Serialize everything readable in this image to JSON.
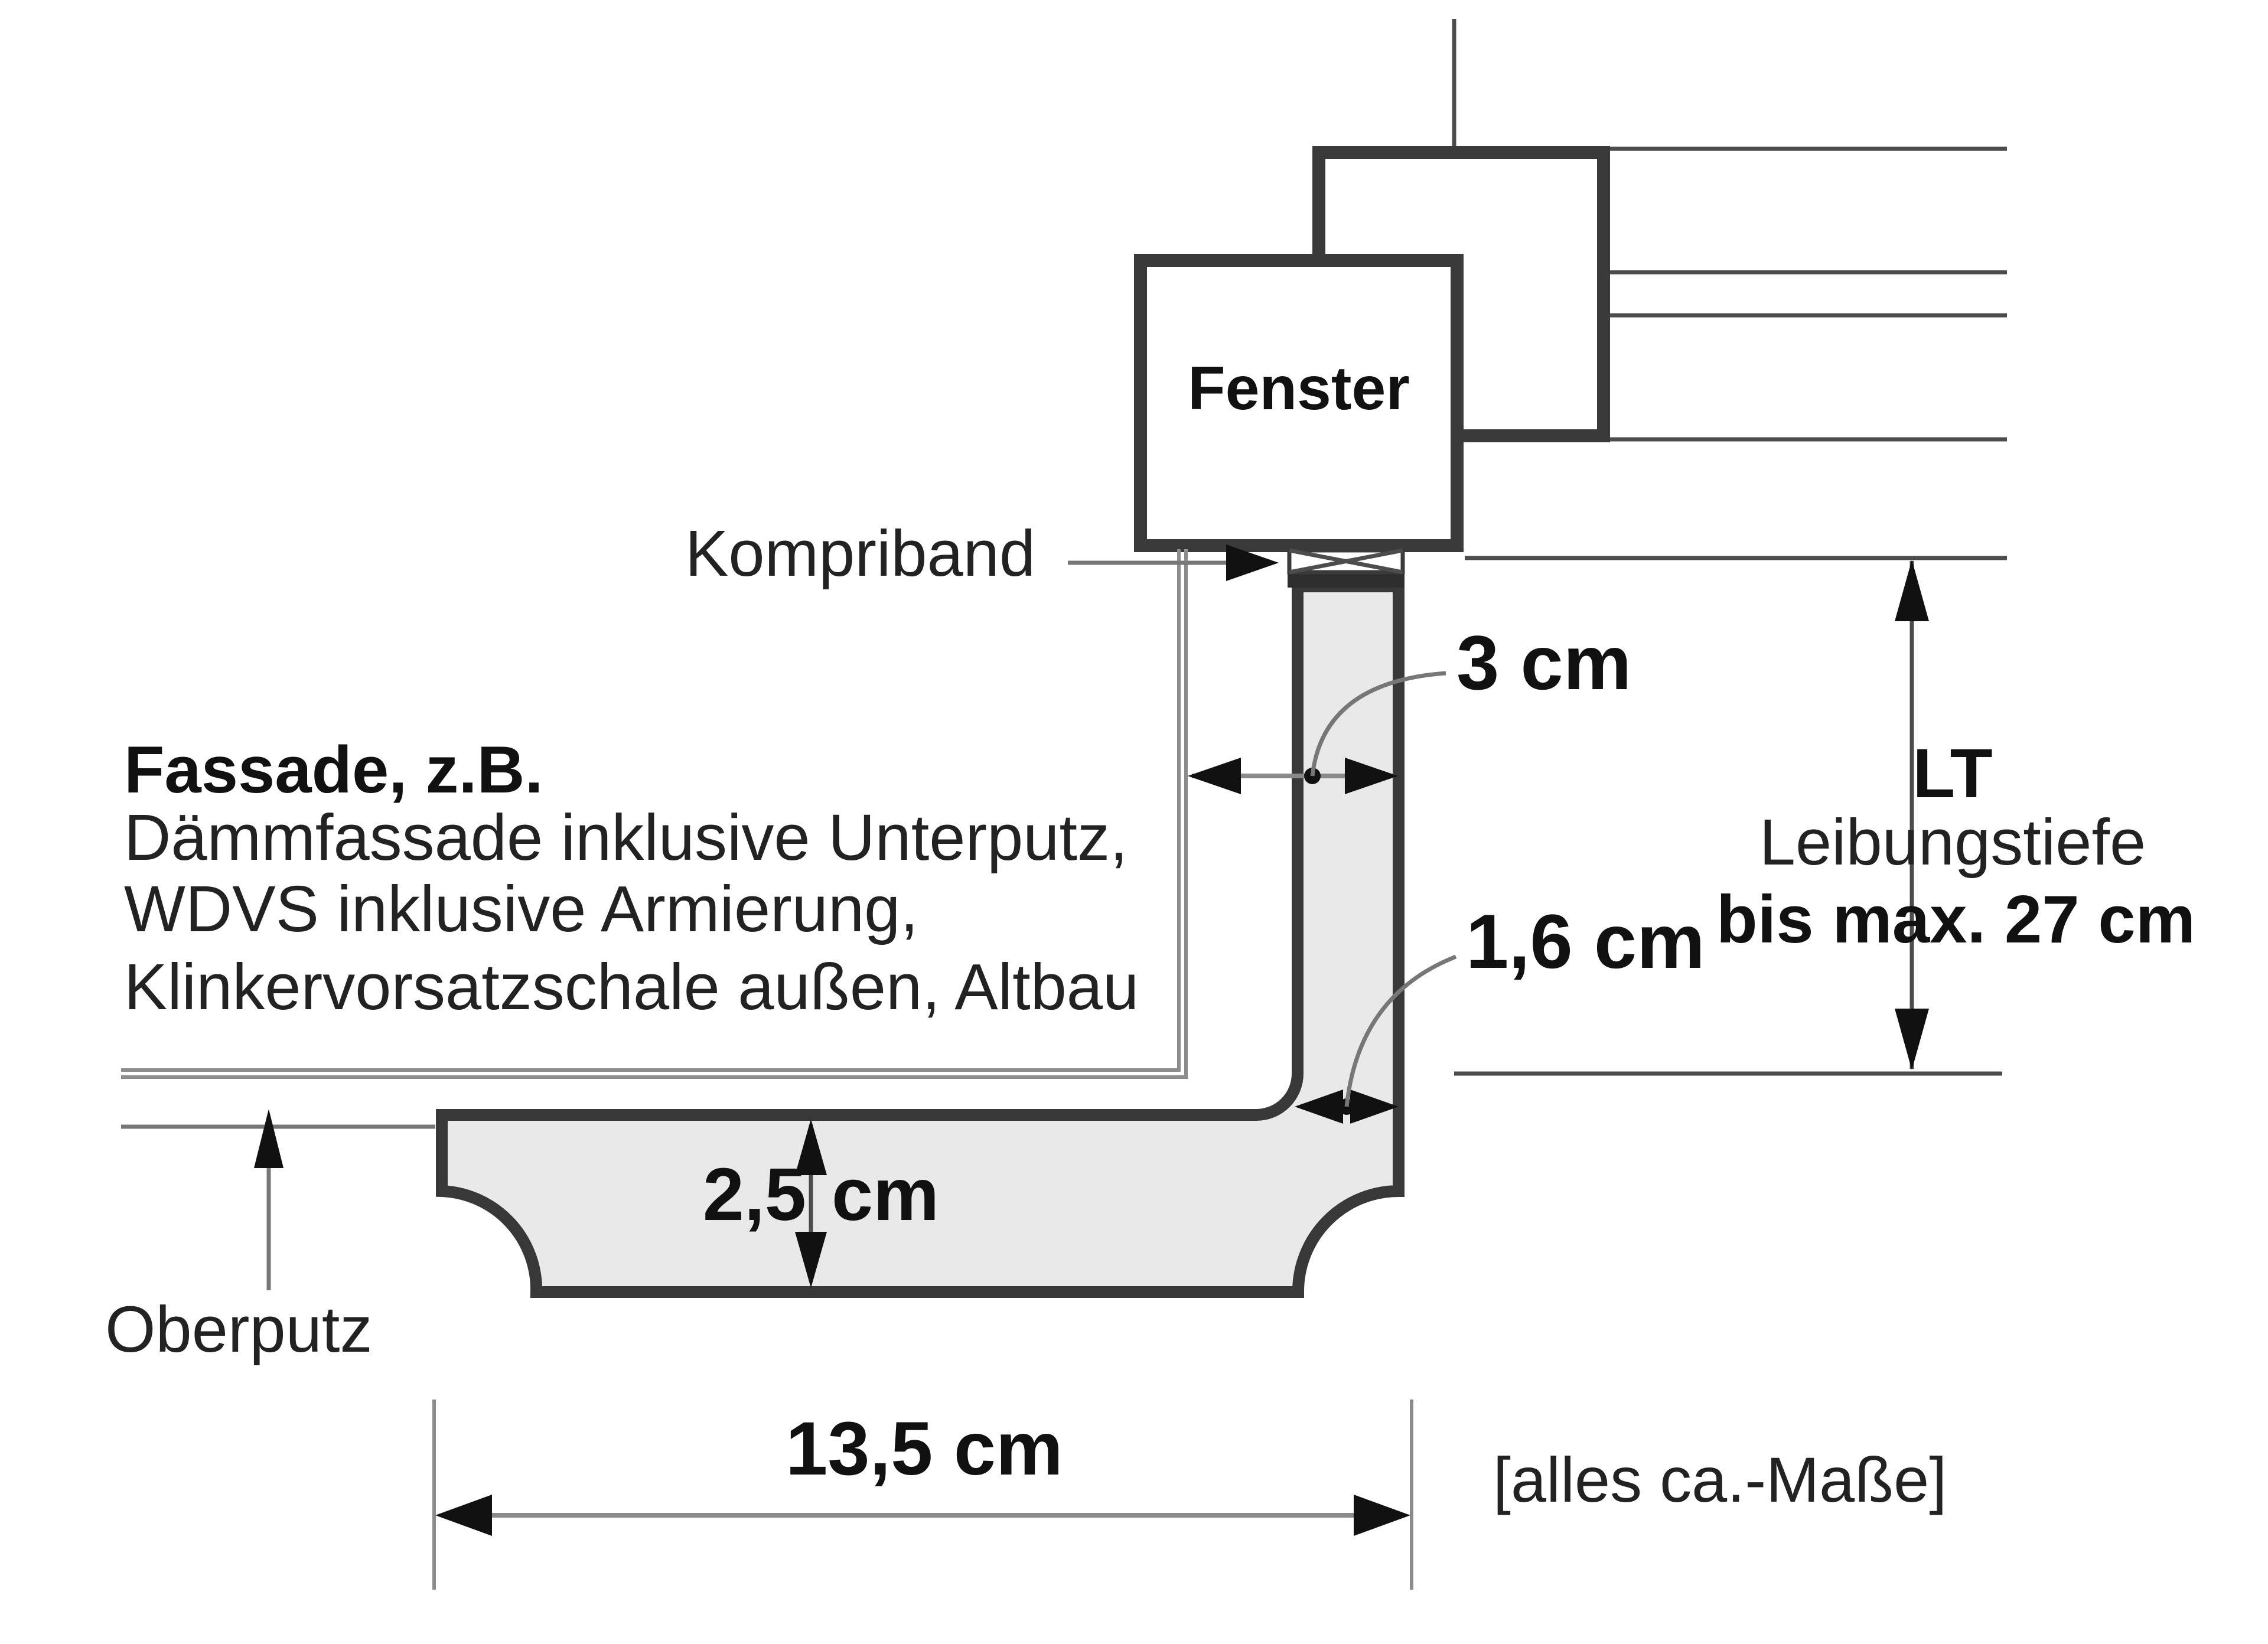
{
  "labels": {
    "fenster": "Fenster",
    "kompriband": "Kompriband",
    "fassade_heading": "Fassade, z.B.",
    "fassade_line1": "Dämmfassade inklusive Unterputz,",
    "fassade_line2": "WDVS inklusive Armierung,",
    "fassade_line3": "Klinkervorsatzschale außen, Altbau",
    "oberputz": "Oberputz",
    "note": "[alles ca.-Maße]"
  },
  "dimensions": {
    "reveal_gap": {
      "value": "3 cm"
    },
    "profile_thickness": {
      "value": "1,6 cm"
    },
    "sill_front_height": {
      "number": "2,5",
      "unit": "cm"
    },
    "sill_depth": {
      "value": "13,5 cm"
    },
    "reveal_depth": {
      "abbr": "LT",
      "name": "Leibungstiefe",
      "max": "bis max. 27 cm"
    }
  },
  "colors": {
    "line-dark": "#3a3a3a",
    "line-thin": "#4d4d4d",
    "line-light": "#8c8c8c",
    "leader": "#777777",
    "fill-gray": "#e9e9e9",
    "bar-dark": "#2d2d2d",
    "ink": "#111111",
    "bg": "#ffffff"
  }
}
